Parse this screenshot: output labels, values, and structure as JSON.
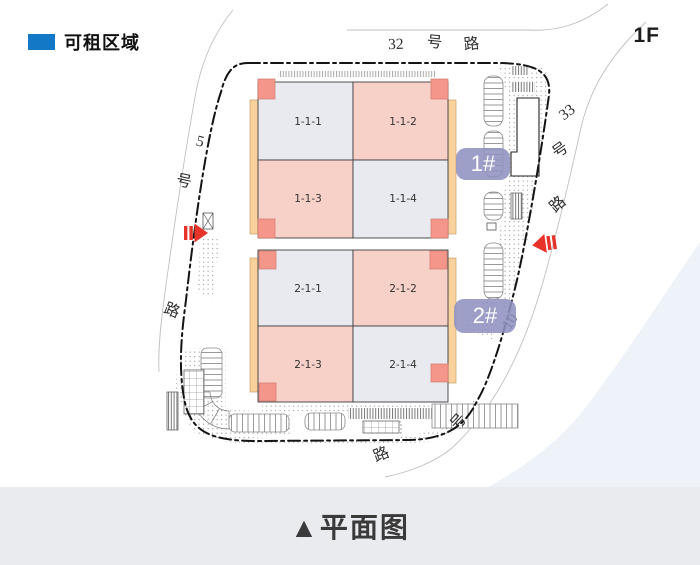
{
  "legend": {
    "label": "可租区域"
  },
  "floor_label": "1F",
  "caption": "▲平面图",
  "roads": {
    "top": {
      "name": "32号路",
      "chars": [
        "32",
        "号",
        "路"
      ]
    },
    "left": {
      "name": "5号路",
      "chars": [
        "5",
        "号",
        "路"
      ]
    },
    "right": {
      "name": "33号路",
      "chars": [
        "33",
        "号",
        "路"
      ]
    },
    "bottom": {
      "name": "10号路",
      "chars": [
        "10",
        "号",
        "路"
      ]
    }
  },
  "buildings": [
    {
      "badge": "1#",
      "units": [
        {
          "id": "1-1-1",
          "rentable": false
        },
        {
          "id": "1-1-2",
          "rentable": true
        },
        {
          "id": "1-1-3",
          "rentable": true
        },
        {
          "id": "1-1-4",
          "rentable": false
        }
      ]
    },
    {
      "badge": "2#",
      "units": [
        {
          "id": "2-1-1",
          "rentable": false
        },
        {
          "id": "2-1-2",
          "rentable": true
        },
        {
          "id": "2-1-3",
          "rentable": true
        },
        {
          "id": "2-1-4",
          "rentable": false
        }
      ]
    }
  ],
  "colors": {
    "accent-blue": "#1379c6",
    "rentable-fill": "#f7d1c8",
    "unit-fill": "#e9eaef",
    "corner-fill": "#f5968b",
    "canopy-fill": "#f8d19c",
    "badge-fill": "#8f92c0",
    "arrow-red": "#e73329",
    "caption-band": "#e9ebee"
  }
}
